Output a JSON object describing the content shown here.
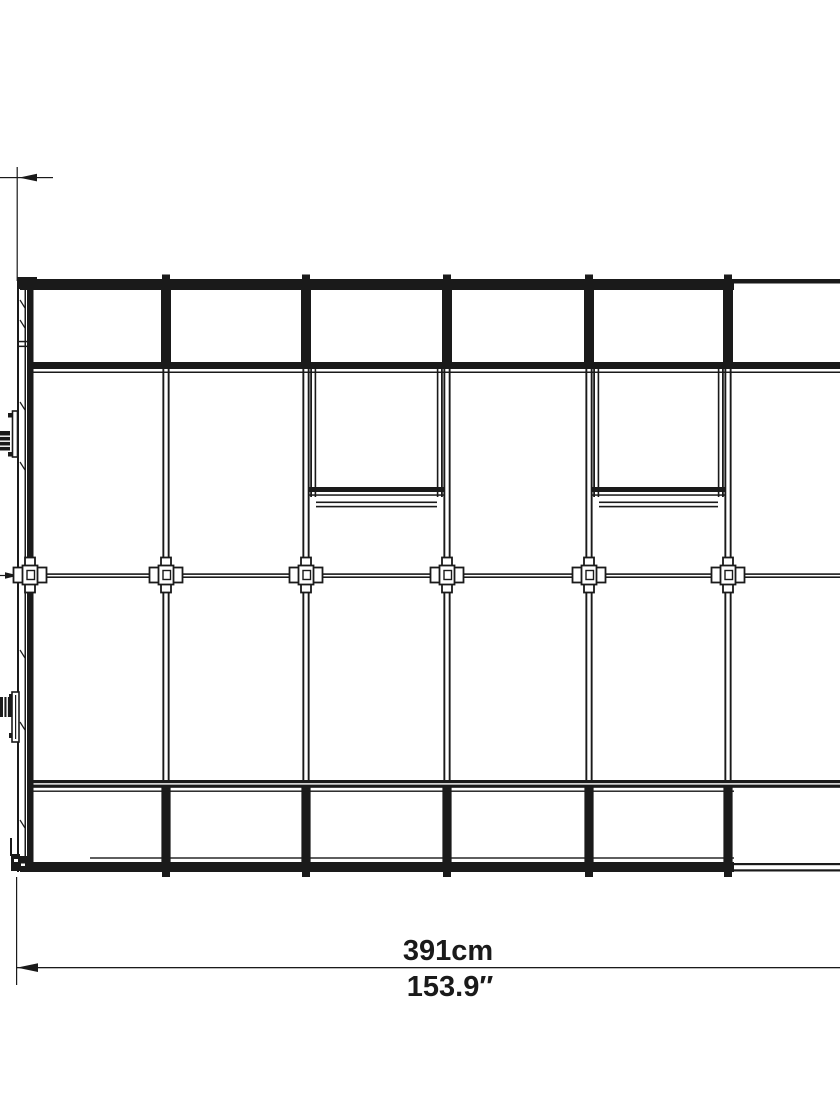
{
  "drawing": {
    "line_color": "#1a1a1a",
    "background_color": "#ffffff"
  },
  "dimension": {
    "metric": "391cm",
    "imperial": "153.9″"
  }
}
